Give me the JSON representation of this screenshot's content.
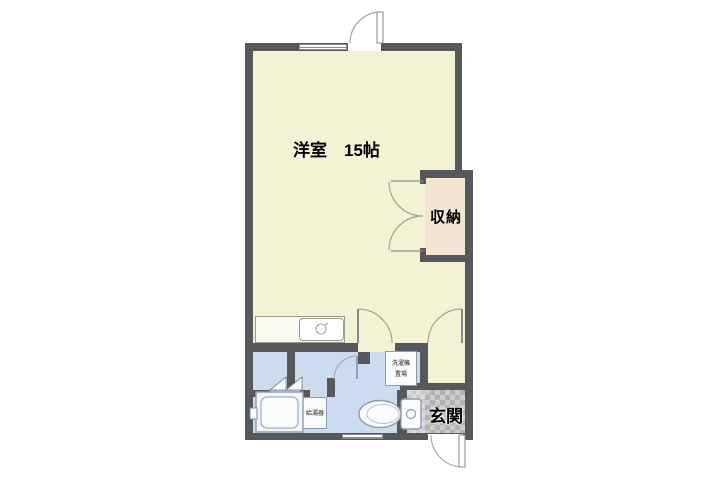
{
  "floorplan": {
    "rooms": {
      "living": {
        "label": "洋室　15帖"
      },
      "closet": {
        "label": "収納"
      },
      "entrance": {
        "label": "玄関"
      },
      "washer_space": {
        "line1": "洗濯機",
        "line2": "置場"
      },
      "water_heater": {
        "label": "給湯器"
      }
    },
    "colors": {
      "wall": "#57585c",
      "living_floor": "#f4f2d5",
      "wet_area_floor": "#ccdbed",
      "closet_floor": "#f3e5d4",
      "entrance_tile_dark": "#b2b2b2",
      "entrance_tile_light": "#cccccc",
      "fixture_stroke": "#8d9cb2",
      "door_arc": "#a9a293",
      "background": "#ffffff"
    }
  }
}
